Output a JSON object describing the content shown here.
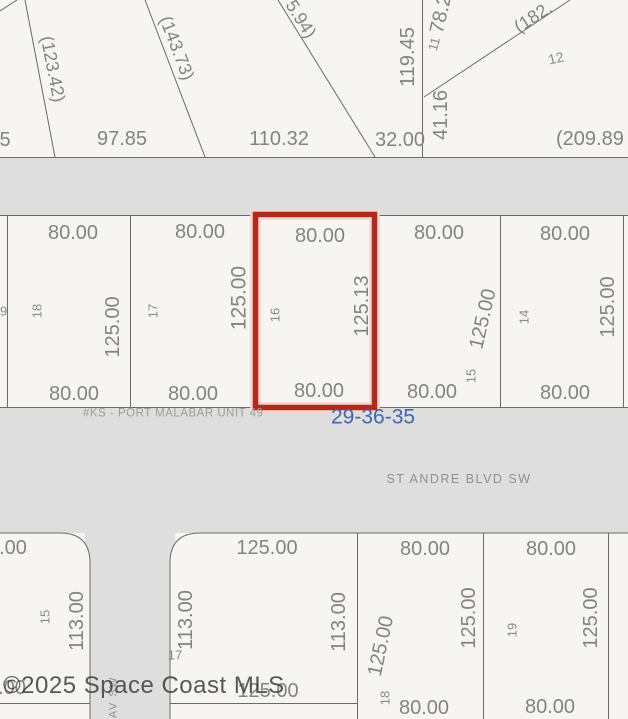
{
  "colors": {
    "lot": "#f6f5f1",
    "road": "#dedede",
    "line": "#6a6a6a",
    "dim_text": "#838383",
    "num_text": "#8a8a8a",
    "highlight": "#b2291d",
    "highlight_halo": "#f3d7d2",
    "section_text": "#3f66b0",
    "plat_text": "#9c9c9c",
    "street_text": "#909090",
    "watermark_text": "#3d3d3d"
  },
  "annotations": {
    "watermark": "©2025 Space Coast MLS",
    "plat_label": "#KS - PORT MALABAR UNIT 49",
    "section_code": "29-36-35"
  },
  "streets": {
    "horizontal": "ST ANDRE BLVD SW",
    "vertical_partial": "AV SW"
  },
  "top_section": {
    "dims": {
      "d123_42": "(123.42)",
      "d143_73": "(143.73)",
      "d5_94": "5.94)",
      "d97_85": "97.85",
      "d110_32": "110.32",
      "d_left_partial": "5",
      "d119_45": "119.45",
      "d78_2": "78.2",
      "d182": "(182.",
      "d41_16": "41.16",
      "d32_00": "32.00",
      "d209_89": "(209.89"
    },
    "lot_numbers": {
      "n11": "11",
      "n12": "12"
    }
  },
  "middle_row": {
    "lots": [
      {
        "number": "19"
      },
      {
        "number": "18",
        "top": "80.00",
        "side": "125.00",
        "bottom": "80.00"
      },
      {
        "number": "17",
        "top": "80.00",
        "side": "125.00",
        "bottom": "80.00"
      },
      {
        "number": "16",
        "top": "80.00",
        "side": "125.13",
        "bottom": "80.00",
        "highlighted": true
      },
      {
        "number": "15",
        "top": "80.00",
        "side": "125.00",
        "bottom": "80.00"
      },
      {
        "number": "14",
        "top": "80.00",
        "side": "125.00",
        "bottom": "80.00"
      }
    ]
  },
  "bottom_row": {
    "lots": [
      {
        "number": "15",
        "top": ".00",
        "side": "113.00",
        "bottom": ".00"
      },
      {
        "number": "17",
        "top": "125.00",
        "left": "113.00",
        "right": "113.00",
        "bottom": "125.00"
      },
      {
        "number": "18",
        "top": "80.00",
        "left": "125.00",
        "right": "125.00",
        "bottom": "80.00"
      },
      {
        "number": "19",
        "top": "80.00",
        "side": "125.00",
        "bottom": "80.00"
      }
    ]
  }
}
